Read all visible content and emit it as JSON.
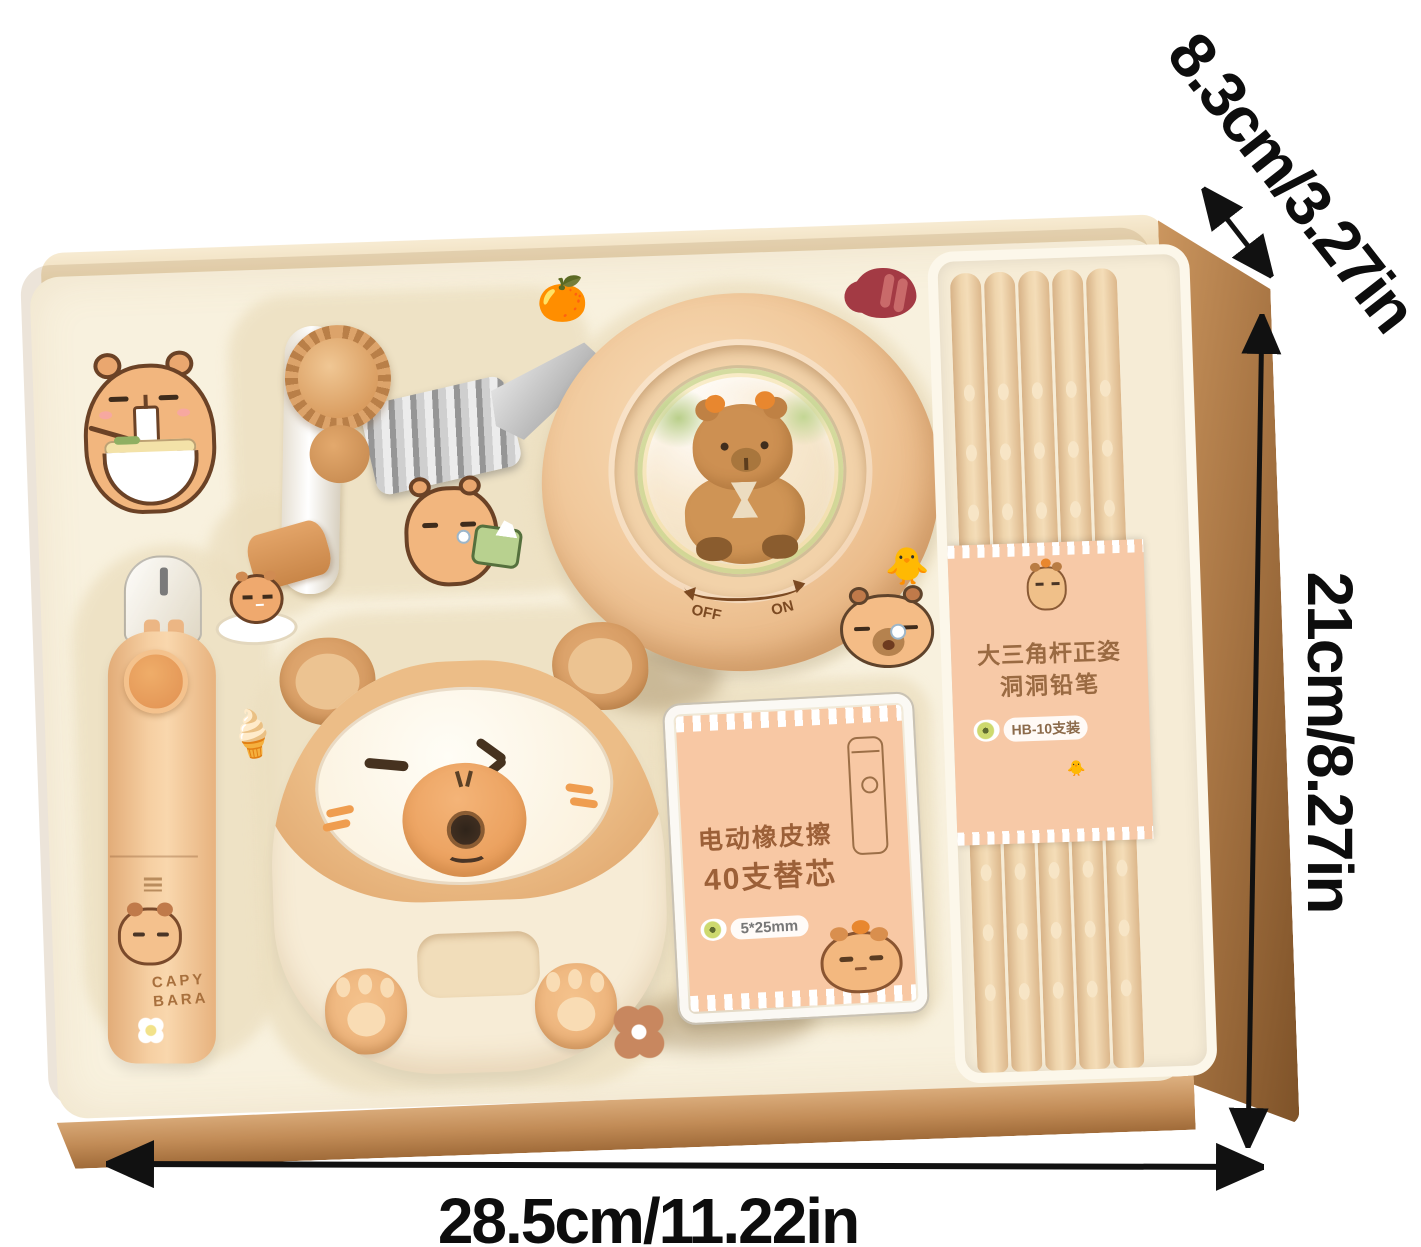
{
  "annotations": {
    "depth_label": "8.3cm/3.27in",
    "height_label": "21cm/8.27in",
    "width_label": "28.5cm/11.22in"
  },
  "round_device": {
    "switch_off": "OFF",
    "switch_on": "ON"
  },
  "refill_box": {
    "line1": "电动橡皮擦",
    "line2": "40支替芯",
    "size_badge": "5*25mm"
  },
  "pencil_wrap": {
    "line1": "大三角杆正姿",
    "line2": "洞洞铅笔",
    "badge": "HB-10支装",
    "chick_glyph": "🐥"
  },
  "eraser_pen": {
    "brand_top": "CAPY",
    "brand_bottom": "BARA"
  },
  "stickers": {
    "ice_cream_glyph": "🍦",
    "orange_glyph": "🍊",
    "duck_glyph": "🐥"
  },
  "colors": {
    "box_side_brown": "#aa7745",
    "box_front_tan": "#c28c57",
    "tray_cream": "#f8f1de",
    "item_peach": "#f6cfa2",
    "label_peach": "#f8c8a4",
    "label_text_brown": "#9c6038",
    "arrow_black": "#111111"
  }
}
